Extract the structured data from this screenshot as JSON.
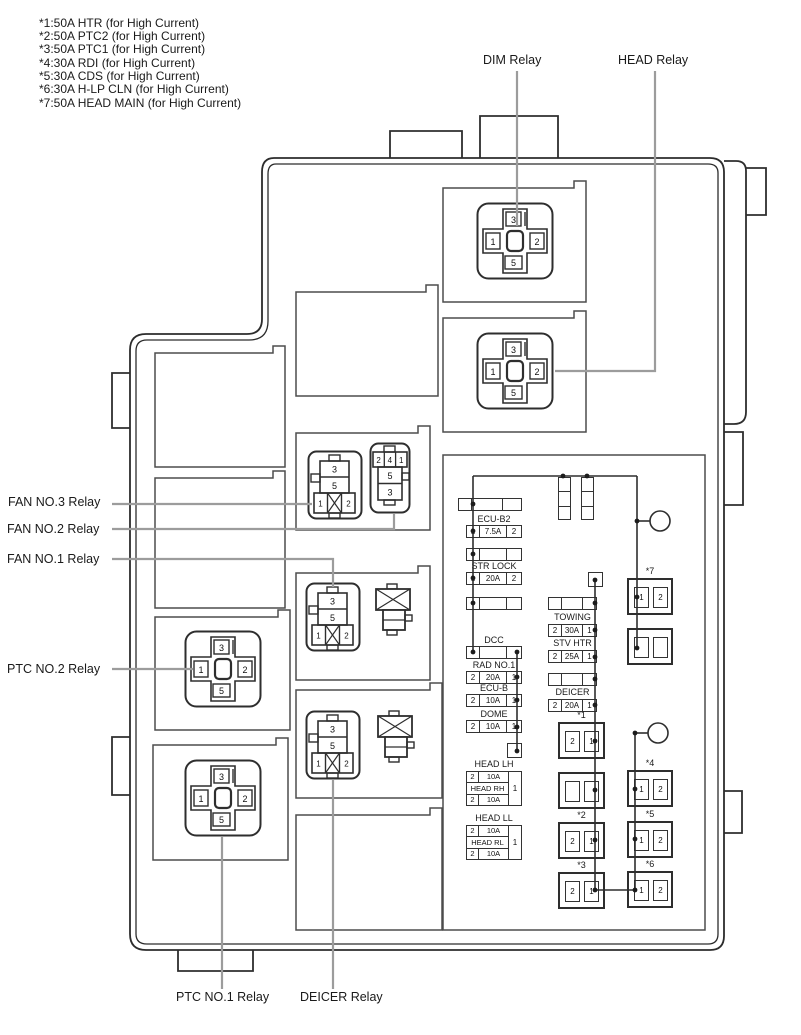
{
  "legend": {
    "lines": [
      "*1:50A HTR (for High Current)",
      "*2:50A PTC2 (for High Current)",
      "*3:50A PTC1 (for High Current)",
      "*4:30A RDI (for High Current)",
      "*5:30A CDS (for High Current)",
      "*6:30A H-LP CLN (for High Current)",
      "*7:50A HEAD MAIN (for High Current)"
    ]
  },
  "callouts": {
    "dim": "DIM Relay",
    "head": "HEAD Relay",
    "fan3": "FAN NO.3 Relay",
    "fan2": "FAN NO.2 Relay",
    "fan1": "FAN NO.1 Relay",
    "ptc2": "PTC NO.2 Relay",
    "ptc1": "PTC NO.1 Relay",
    "deicer": "DEICER Relay"
  },
  "pins": {
    "cross": {
      "top": "3",
      "left": "1",
      "right": "2",
      "bottom": "5"
    },
    "a": {
      "r1": "3",
      "r2": "5",
      "b1": "1",
      "b2": "2"
    },
    "b": {
      "t1": "2",
      "t2": "4",
      "t3": "1",
      "r1": "5",
      "r2": "3"
    }
  },
  "fuses": {
    "ecu_b2": {
      "label": "ECU-B2",
      "c1": "1",
      "c2": "7.5A",
      "c3": "2"
    },
    "str_lock": {
      "label": "STR LOCK",
      "c1": "1",
      "c2": "20A",
      "c3": "2"
    },
    "dcc": {
      "label": "DCC"
    },
    "rad_no1": {
      "label": "RAD NO.1",
      "c1": "2",
      "c2": "20A",
      "c3": "1"
    },
    "ecu_b": {
      "label": "ECU-B",
      "c1": "2",
      "c2": "10A",
      "c3": "1"
    },
    "dome": {
      "label": "DOME",
      "c1": "2",
      "c2": "10A",
      "c3": "1"
    },
    "head_lh": {
      "label": "HEAD LH",
      "c1": "2",
      "c2": "10A"
    },
    "head_rh": {
      "label": "HEAD RH",
      "c1": "2",
      "c2": "10A",
      "shared": "1"
    },
    "head_ll": {
      "label": "HEAD LL",
      "c1": "2",
      "c2": "10A"
    },
    "head_rl": {
      "label": "HEAD RL",
      "c1": "2",
      "c2": "10A",
      "shared": "1"
    },
    "towing": {
      "label": "TOWING",
      "c1": "2",
      "c2": "30A",
      "c3": "1"
    },
    "stv_htr": {
      "label": "STV HTR",
      "c1": "2",
      "c2": "25A",
      "c3": "1"
    },
    "deicer": {
      "label": "DEICER",
      "c1": "2",
      "c2": "20A",
      "c3": "1"
    },
    "s1": {
      "label": "*1",
      "c1": "2",
      "c2": "1"
    },
    "s2": {
      "label": "*2",
      "c1": "2",
      "c2": "1"
    },
    "s3": {
      "label": "*3",
      "c1": "2",
      "c2": "1"
    },
    "s4": {
      "label": "*4",
      "c1": "1",
      "c2": "2"
    },
    "s5": {
      "label": "*5",
      "c1": "1",
      "c2": "2"
    },
    "s6": {
      "label": "*6",
      "c1": "1",
      "c2": "2"
    },
    "s7": {
      "label": "*7",
      "c1": "1",
      "c2": "2"
    }
  },
  "colors": {
    "line": "#2e2e2e",
    "panel": "#4d4d4d",
    "leader": "#9c9c9c",
    "text": "#111111"
  }
}
